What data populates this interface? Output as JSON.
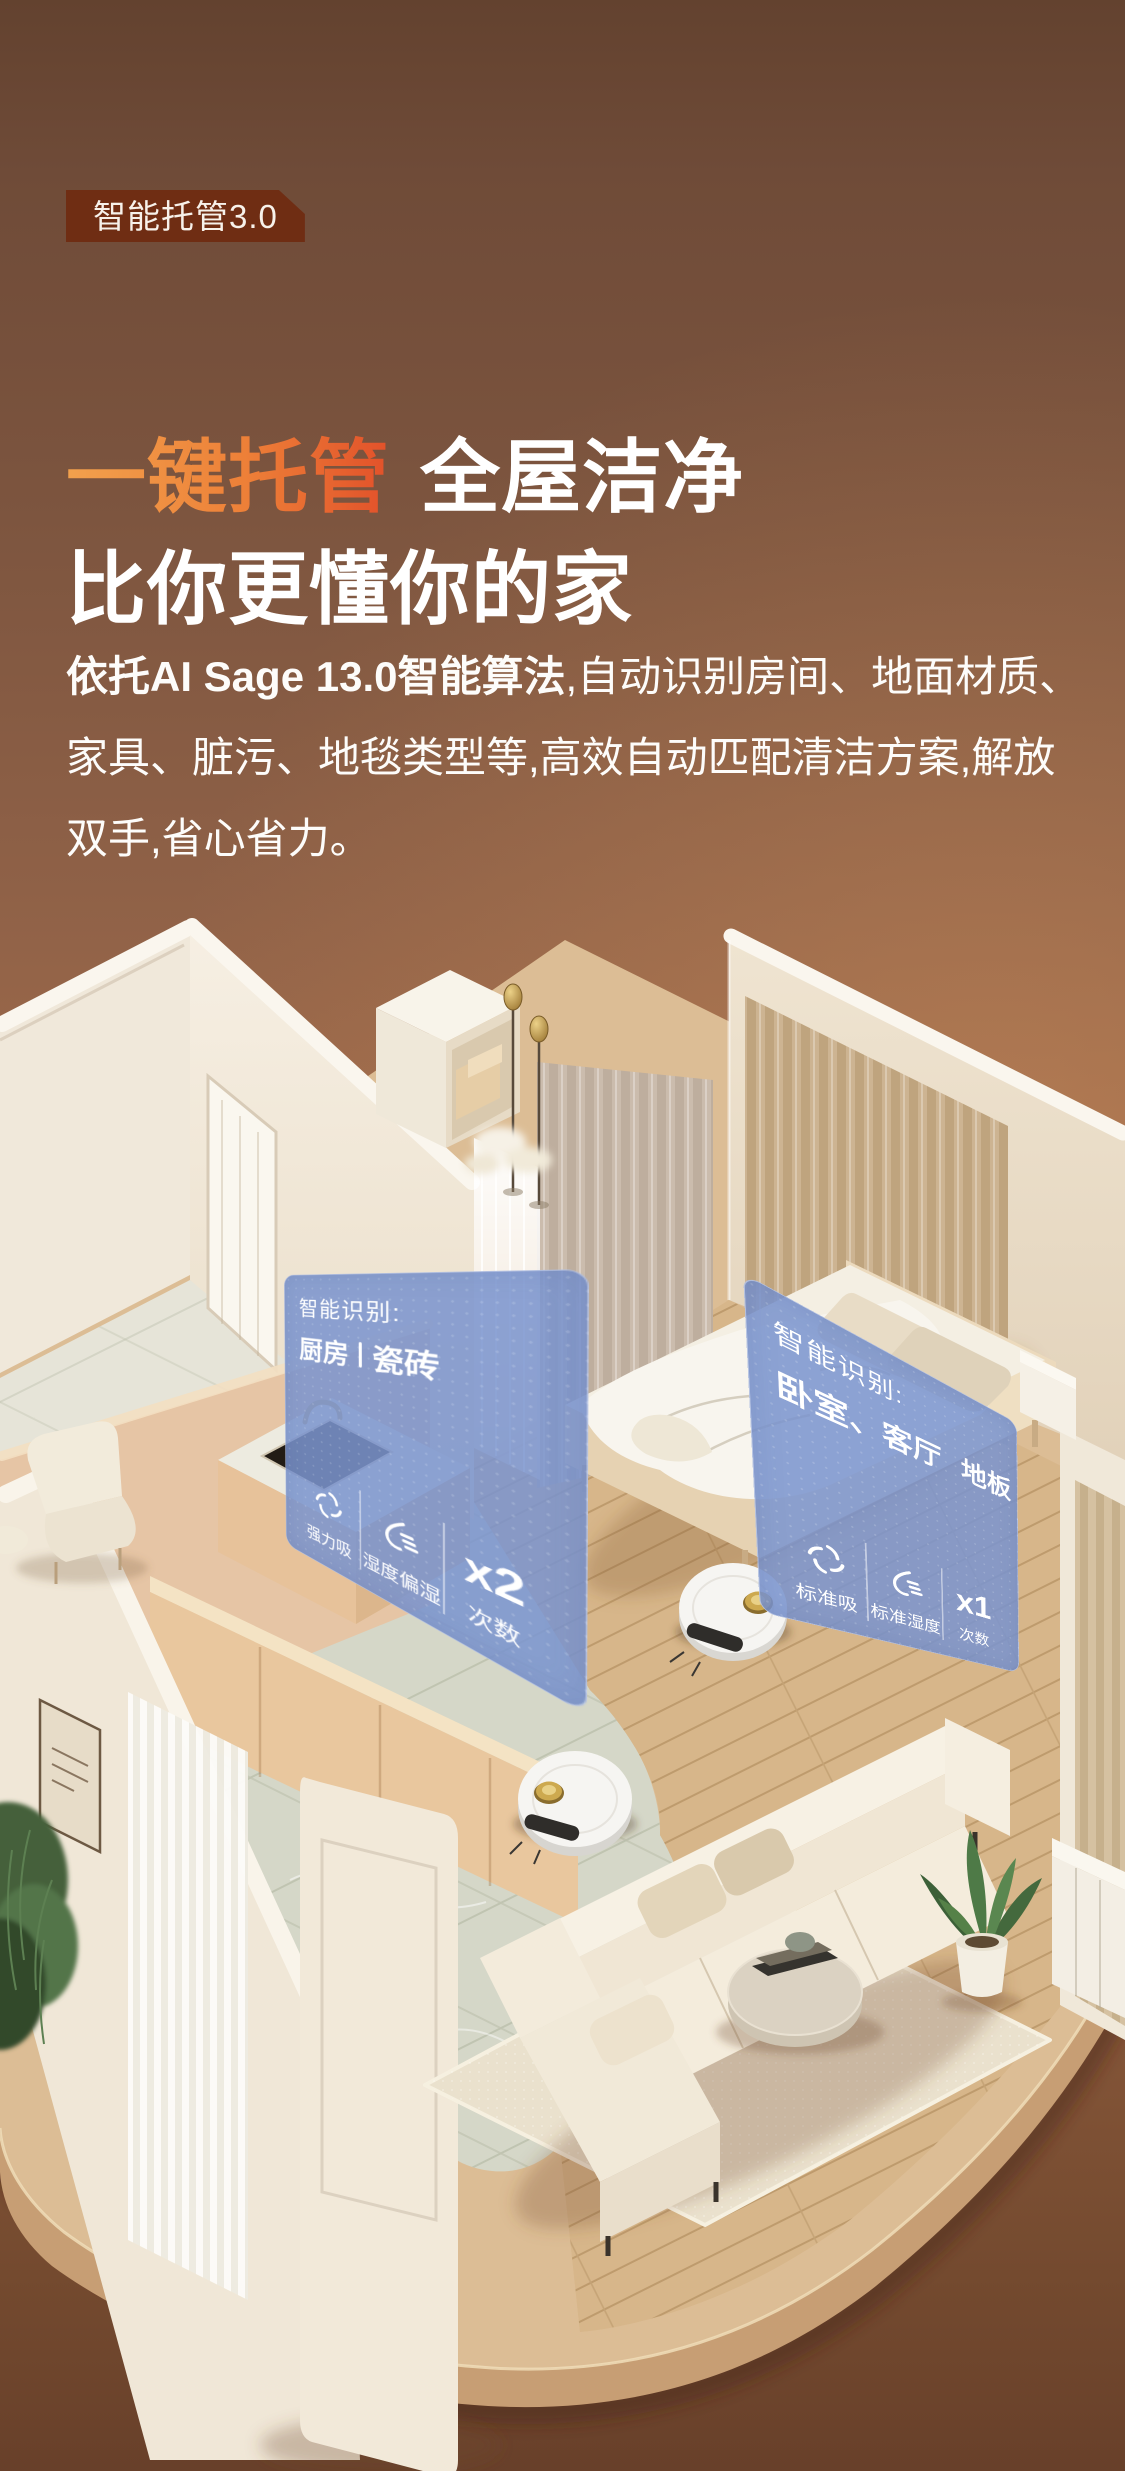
{
  "badge": {
    "label": "智能托管3.0"
  },
  "title": {
    "highlight": "一键托管",
    "rest": "全屋洁净",
    "line2": "比你更懂你的家"
  },
  "paragraph": {
    "line1_bold": "依托AI Sage 13.0智能算法",
    "line1_rest": ",自动识别房间、地面材质、",
    "line2": "家具、脏污、地毯类型等,高效自动匹配清洁方案,解放",
    "line3": "双手,省心省力。"
  },
  "cards": {
    "left": {
      "title": "智能识别:",
      "room": "厨房",
      "floor": "瓷砖",
      "items": [
        {
          "icon": "fan-suction-icon",
          "label": "强力吸"
        },
        {
          "icon": "humidity-drop-icon",
          "label": "湿度偏湿"
        },
        {
          "value": "x2",
          "label": "次数"
        }
      ]
    },
    "right": {
      "title": "智能识别:",
      "room": "卧室、客厅",
      "floor": "地板",
      "items": [
        {
          "icon": "fan-suction-icon",
          "label": "标准吸"
        },
        {
          "icon": "humidity-drop-icon",
          "label": "标准湿度"
        },
        {
          "value": "x1",
          "label": "次数"
        }
      ]
    }
  },
  "colors": {
    "accent_gradient_start": "#f2a14d",
    "accent_gradient_end": "#e2512a",
    "badge_bg": "#6f2d13",
    "card_blue": "rgba(122,148,206,0.86)",
    "headline_text": "#ffffff",
    "background_top": "#63422f",
    "background_mid": "#aa724e",
    "background_bottom": "#68402a",
    "platform_tan": "#dcbd95"
  }
}
